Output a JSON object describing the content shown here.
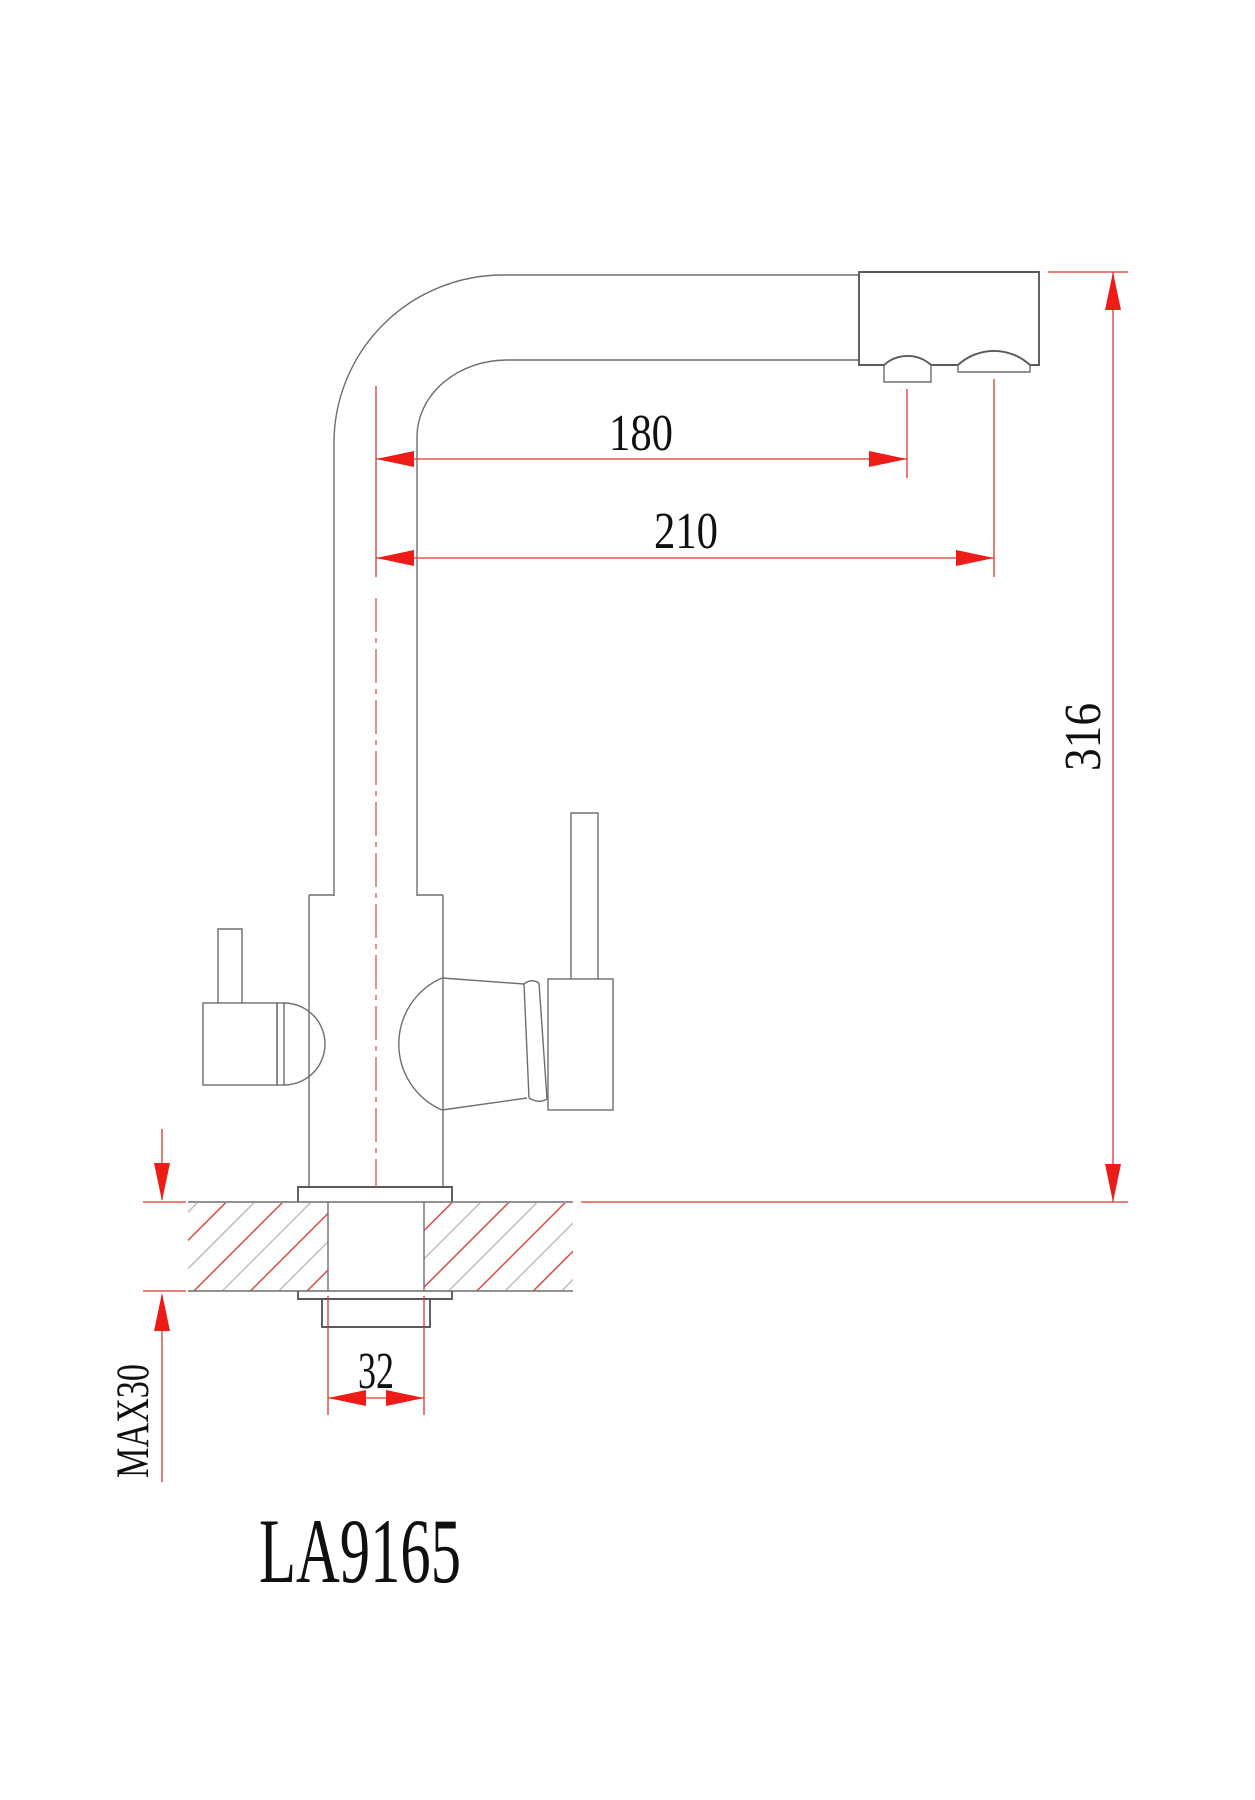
{
  "drawing": {
    "product_code": "LA9165",
    "type_note": "faucet installation dimension drawing",
    "dimensions": {
      "reach_filtered_outlet": "180",
      "reach_main_outlet": "210",
      "overall_height": "316",
      "mounting_hole_width": "32",
      "max_counter_thickness": "MAX30"
    },
    "colors": {
      "dimension_red": "#dd352c",
      "arrow_red": "#ee1c16",
      "outline_gray": "#6e6e6e",
      "hatch_red": "#cf3f36",
      "hatch_gray": "#b4b4b4",
      "text_black": "#101010",
      "background": "#ffffff"
    }
  }
}
